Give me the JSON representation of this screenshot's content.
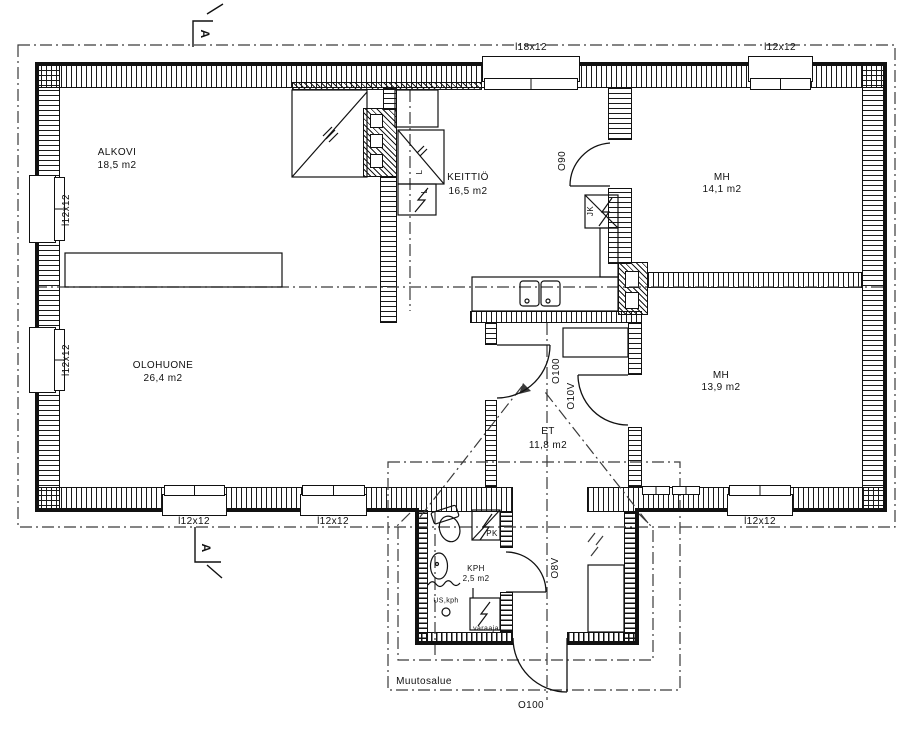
{
  "plan": {
    "rooms": {
      "alkovi": {
        "name": "ALKOVI",
        "area": "18,5 m2"
      },
      "keittio": {
        "name": "KEITTIÖ",
        "area": "16,5 m2"
      },
      "mh_top": {
        "name": "MH",
        "area": "14,1 m2"
      },
      "olohuone": {
        "name": "OLOHUONE",
        "area": "26,4 m2"
      },
      "mh_mid": {
        "name": "MH",
        "area": "13,9 m2"
      },
      "et": {
        "name": "ET",
        "area": "11,8 m2"
      },
      "kph": {
        "name": "KPH",
        "area": "2,5 m2"
      }
    },
    "windows": {
      "top_large": "l18x12",
      "top_right": "l12x12",
      "left_upper": "l12x12",
      "left_lower": "l12x12",
      "bottom_left": "l12x12",
      "bottom_mid": "l12x12",
      "bottom_right": "l12x12"
    },
    "doors": {
      "kitchen_bedroom": "O90",
      "hall_living": "O100",
      "hall_bedroom": "O10V",
      "bathroom": "O8V",
      "entrance": "O100"
    },
    "fixtures": {
      "fridge": "JK",
      "washing_machine": "PK",
      "stove_upper": "L",
      "stove_lower": "L",
      "water_heater": "varaaja",
      "floor_drain_note": "US,kph"
    },
    "annotations": {
      "change_area": "Muutosalue",
      "section_marker_top": "A",
      "section_marker_bottom": "A"
    },
    "colors": {
      "line": "#111111",
      "reference": "#3a3a3a",
      "background": "#ffffff"
    }
  }
}
